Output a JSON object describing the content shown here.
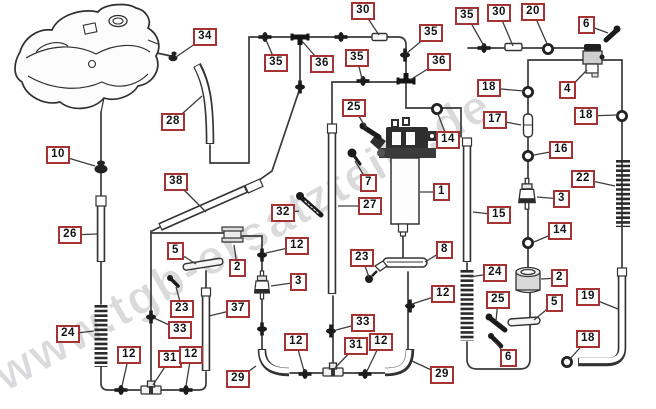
{
  "watermark": {
    "text": "www.tgb-ersatzteile.de",
    "color": "#b5b5ba"
  },
  "colors": {
    "background": "#ffffff",
    "line_art": "#3a3a3a",
    "callout_border": "#a53333",
    "callout_text": "#141414"
  },
  "callouts": [
    {
      "label": "34",
      "x": 193,
      "y": 28,
      "tx": 176,
      "ty": 57
    },
    {
      "label": "30",
      "x": 351,
      "y": 2,
      "tx": 379,
      "ty": 35
    },
    {
      "label": "35",
      "x": 264,
      "y": 54,
      "tx": 266,
      "ty": 40
    },
    {
      "label": "36",
      "x": 310,
      "y": 55,
      "tx": 302,
      "ty": 41
    },
    {
      "label": "35",
      "x": 345,
      "y": 49,
      "tx": 362,
      "ty": 79
    },
    {
      "label": "35",
      "x": 419,
      "y": 24,
      "tx": 407,
      "ty": 53
    },
    {
      "label": "36",
      "x": 427,
      "y": 53,
      "tx": 410,
      "ty": 80
    },
    {
      "label": "35",
      "x": 455,
      "y": 7,
      "tx": 484,
      "ty": 46
    },
    {
      "label": "30",
      "x": 487,
      "y": 4,
      "tx": 513,
      "ty": 46
    },
    {
      "label": "20",
      "x": 521,
      "y": 3,
      "tx": 548,
      "ty": 46
    },
    {
      "label": "6",
      "x": 578,
      "y": 16,
      "tx": 608,
      "ty": 33
    },
    {
      "label": "4",
      "x": 559,
      "y": 81,
      "tx": 587,
      "ty": 70
    },
    {
      "label": "18",
      "x": 477,
      "y": 79,
      "tx": 524,
      "ty": 91
    },
    {
      "label": "17",
      "x": 483,
      "y": 111,
      "tx": 521,
      "ty": 125
    },
    {
      "label": "18",
      "x": 574,
      "y": 107,
      "tx": 618,
      "ty": 115
    },
    {
      "label": "16",
      "x": 549,
      "y": 141,
      "tx": 534,
      "ty": 155
    },
    {
      "label": "22",
      "x": 571,
      "y": 170,
      "tx": 615,
      "ty": 186
    },
    {
      "label": "3",
      "x": 553,
      "y": 190,
      "tx": 537,
      "ty": 197
    },
    {
      "label": "14",
      "x": 548,
      "y": 222,
      "tx": 534,
      "ty": 242
    },
    {
      "label": "15",
      "x": 487,
      "y": 206,
      "tx": 473,
      "ty": 212
    },
    {
      "label": "25",
      "x": 342,
      "y": 99,
      "tx": 366,
      "ty": 128
    },
    {
      "label": "14",
      "x": 436,
      "y": 131,
      "tx": 438,
      "ty": 114
    },
    {
      "label": "1",
      "x": 433,
      "y": 183,
      "tx": 420,
      "ty": 192
    },
    {
      "label": "7",
      "x": 360,
      "y": 174,
      "tx": 355,
      "ty": 161
    },
    {
      "label": "27",
      "x": 358,
      "y": 197,
      "tx": 338,
      "ty": 206
    },
    {
      "label": "32",
      "x": 271,
      "y": 204,
      "tx": 299,
      "ty": 211
    },
    {
      "label": "12",
      "x": 285,
      "y": 237,
      "tx": 266,
      "ty": 253
    },
    {
      "label": "2",
      "x": 229,
      "y": 259,
      "tx": 234,
      "ty": 245
    },
    {
      "label": "5",
      "x": 167,
      "y": 242,
      "tx": 196,
      "ty": 264
    },
    {
      "label": "23",
      "x": 170,
      "y": 300,
      "tx": 176,
      "ty": 287
    },
    {
      "label": "33",
      "x": 168,
      "y": 321,
      "tx": 154,
      "ty": 318
    },
    {
      "label": "37",
      "x": 226,
      "y": 300,
      "tx": 209,
      "ty": 316
    },
    {
      "label": "3",
      "x": 290,
      "y": 273,
      "tx": 271,
      "ty": 286
    },
    {
      "label": "23",
      "x": 350,
      "y": 249,
      "tx": 369,
      "ty": 277
    },
    {
      "label": "8",
      "x": 436,
      "y": 241,
      "tx": 425,
      "ty": 262
    },
    {
      "label": "10",
      "x": 46,
      "y": 146,
      "tx": 95,
      "ty": 166
    },
    {
      "label": "28",
      "x": 161,
      "y": 113,
      "tx": 202,
      "ty": 96
    },
    {
      "label": "38",
      "x": 164,
      "y": 173,
      "tx": 206,
      "ty": 212
    },
    {
      "label": "26",
      "x": 58,
      "y": 226,
      "tx": 97,
      "ty": 234
    },
    {
      "label": "24",
      "x": 56,
      "y": 325,
      "tx": 94,
      "ty": 331
    },
    {
      "label": "12",
      "x": 117,
      "y": 346,
      "tx": 122,
      "ty": 386
    },
    {
      "label": "31",
      "x": 158,
      "y": 350,
      "tx": 153,
      "ty": 385
    },
    {
      "label": "12",
      "x": 179,
      "y": 346,
      "tx": 186,
      "ty": 386
    },
    {
      "label": "29",
      "x": 226,
      "y": 370,
      "tx": 256,
      "ty": 366
    },
    {
      "label": "12",
      "x": 284,
      "y": 333,
      "tx": 304,
      "ty": 371
    },
    {
      "label": "33",
      "x": 351,
      "y": 314,
      "tx": 336,
      "ty": 330
    },
    {
      "label": "31",
      "x": 344,
      "y": 337,
      "tx": 335,
      "ty": 368
    },
    {
      "label": "12",
      "x": 369,
      "y": 333,
      "tx": 367,
      "ty": 371
    },
    {
      "label": "29",
      "x": 430,
      "y": 366,
      "tx": 412,
      "ty": 361
    },
    {
      "label": "12",
      "x": 431,
      "y": 285,
      "tx": 412,
      "ty": 304
    },
    {
      "label": "24",
      "x": 483,
      "y": 264,
      "tx": 470,
      "ty": 277
    },
    {
      "label": "2",
      "x": 551,
      "y": 269,
      "tx": 541,
      "ty": 279
    },
    {
      "label": "25",
      "x": 486,
      "y": 291,
      "tx": 496,
      "ty": 321
    },
    {
      "label": "5",
      "x": 546,
      "y": 294,
      "tx": 534,
      "ty": 320
    },
    {
      "label": "19",
      "x": 576,
      "y": 288,
      "tx": 618,
      "ty": 309
    },
    {
      "label": "18",
      "x": 576,
      "y": 330,
      "tx": 569,
      "ty": 360
    },
    {
      "label": "6",
      "x": 500,
      "y": 349,
      "tx": 495,
      "ty": 342
    }
  ]
}
